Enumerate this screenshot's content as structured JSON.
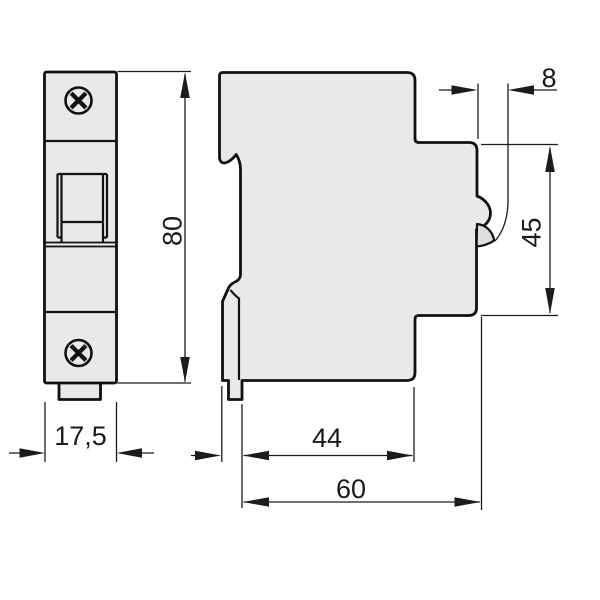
{
  "drawing": {
    "type": "technical-dimension-drawing",
    "labels": {
      "front_width": "17,5",
      "overall_height": "80",
      "handle_depth": "8",
      "face_height": "45",
      "depth_to_step": "44",
      "overall_depth": "60"
    },
    "colors": {
      "background": "#ffffff",
      "body_fill": "#e9e9e9",
      "wedge_fill": "#dedede",
      "line": "#111111",
      "dim_line": "#1c1c1c"
    }
  }
}
